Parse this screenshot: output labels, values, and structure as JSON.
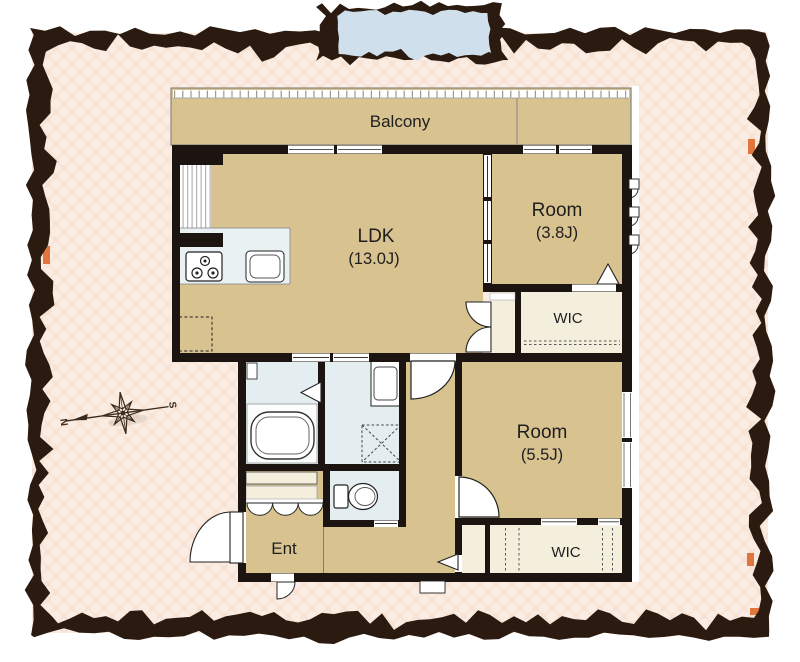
{
  "floorplan": {
    "balcony_label": "Balcony",
    "ldk": {
      "name": "LDK",
      "size": "(13.0J)"
    },
    "room_small": {
      "name": "Room",
      "size": "(3.8J)"
    },
    "wic_upper": {
      "label": "WIC"
    },
    "room_medium": {
      "name": "Room",
      "size": "(5.5J)"
    },
    "wic_lower": {
      "label": "WIC"
    },
    "entrance": {
      "label": "Ent"
    }
  },
  "compass": {
    "north": "N",
    "south": "S"
  },
  "palette": {
    "frame_border": "#2b1a0f",
    "background_pink": "#f8e2d4",
    "polka_dot": "#faece2",
    "washi_tape_blue": "#cfdfeb",
    "room_tan": "#d8c290",
    "closet_cream": "#f4eedd",
    "wet_area_blue": "#e4eef0",
    "wall_black": "#1c1410",
    "accent_orange": "#e0763c"
  }
}
